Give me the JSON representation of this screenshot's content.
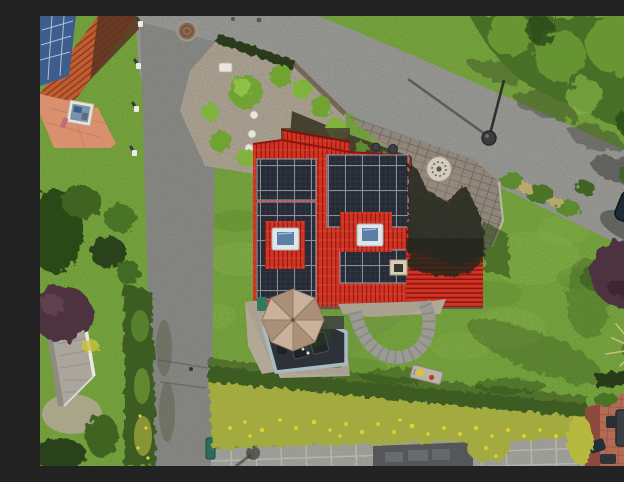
{
  "scene": {
    "type": "aerial-photograph",
    "description": "Aerial drone view of a detached house with a bright red tile roof covered by large dark solar-panel arrays, surrounded by lawn, hedges, a block-paved driveway with a circular stone ornament, a wooden deck with a beige parasol, asphalt streets on two sides, a neighboring house with solar panels at top left, dense tree canopy at top right, a dark parked car at the right edge and a neighboring terracotta patio at bottom right.",
    "solar_arrays": 4,
    "skylights": 2,
    "parasol_segments": 8,
    "bollards": 4
  },
  "labels": {
    "scene": "Aerial drone view of a single-family house with rooftop solar panels",
    "house": "Main house with red tile roof and solar arrays",
    "road_top": "Asphalt street running diagonally along the top",
    "road_left": "Asphalt street running down the left side",
    "sidewalk": "Large-format paved walkway along the bottom",
    "driveway": "Block-paved driveway with circular stone ornament",
    "garden_bed": "Gravel garden bed with ornamental grasses and stepping stones",
    "umbrella": "Beige patio parasol",
    "deck": "Dark wood deck with outdoor furniture",
    "path": "Curved paver garden path",
    "car": "Dark parked car at road edge",
    "canopy": "Dense tree canopy",
    "hedge_bottom": "Clipped hedge with yellow flower border",
    "hedge_left": "Hedge along left street",
    "neighbor": "Neighboring house with blue solar panels and salmon patio",
    "patio_right": "Neighboring terracotta patio with dining set",
    "shed": "Grey garden shed roof",
    "lamp": "Street lamp",
    "manhole": "Manhole cover",
    "chimney": "Chimney",
    "skylight": "Roof skylight",
    "purple_tree": "Dark purple ornamental tree",
    "pampas": "Ornamental pampas grass",
    "lounger": "Small lounger on the lawn",
    "bin": "Small teal post at path corner"
  },
  "colors": {
    "lawn": "#7aa93c",
    "lawnLight": "#9cc455",
    "lawnDark": "#537d27",
    "shadowGreen": "#32511a",
    "asphalt": "#9d9d99",
    "asphaltDark": "#8b8b87",
    "pavement": "#a7a7a1",
    "joint": "#c6c6c0",
    "paver": "#978c80",
    "paverDark": "#6e655b",
    "roofRed": "#d23423",
    "roofRedDark": "#8c150e",
    "solar": "#262b35",
    "solarCell": "#39404e",
    "solarLine": "#99a0aa",
    "skyGlass": "#5b80a8",
    "frameWhite": "#e2e5e8",
    "umbrella": "#c9b19a",
    "umbrellaDark": "#ab9078",
    "deck": "#2d3238",
    "deckFrame": "#a9bac7",
    "hedge": "#3c5c20",
    "hedgeDark": "#2a421a",
    "flower": "#e3cf33",
    "flowerBase": "#a3ab41",
    "canopy": "#476f25",
    "canopyLight": "#6f9d36",
    "canopyDark": "#2c4a16",
    "purple": "#4e3340",
    "terracotta": "#b36b55",
    "terraWall": "#8d4a3c",
    "salmon": "#d9906f",
    "nRoof": "#c05c30",
    "nRoofDark": "#80361c",
    "nPanel": "#3d5d8f",
    "shed": "#aaa69e",
    "gravel": "#b3a896",
    "mulch": "#46412f",
    "car": "#1c2b35",
    "mosaic": "#d2ccc0",
    "white": "#ecece6",
    "houseShadow": "#23281f"
  }
}
